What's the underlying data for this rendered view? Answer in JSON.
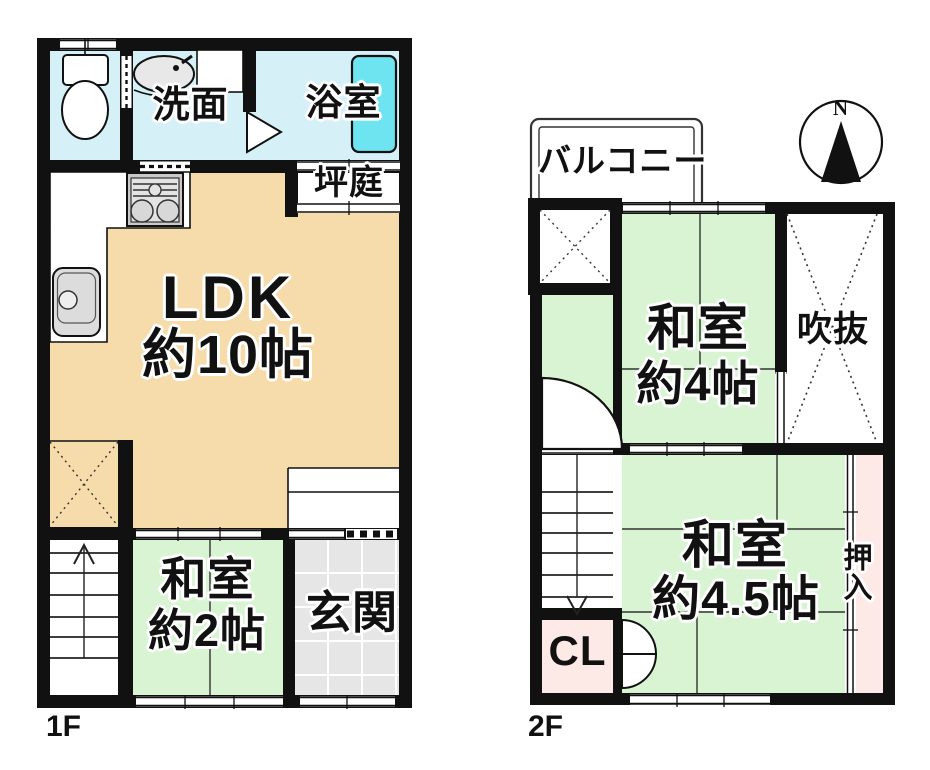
{
  "plan_title": "2-story floor plan",
  "colors": {
    "wall": "#111111",
    "water_room": "#d6f0f7",
    "bathtub": "#6ee4f0",
    "ldk": "#f7dcab",
    "tatami_room": "#d8f4d3",
    "entrance": "#e6e6e6",
    "closet_pink": "#fdeae7",
    "fixture_gray": "#dcdcdc"
  },
  "floor1": {
    "floor_label": "1F",
    "rooms": {
      "senmen": "洗面",
      "bathroom": "浴室",
      "tsuboniwa": "坪庭",
      "ldk_name": "LDK",
      "ldk_size": "約10帖",
      "washitsu_name": "和室",
      "washitsu_size": "約2帖",
      "genkan": "玄関"
    }
  },
  "floor2": {
    "floor_label": "2F",
    "rooms": {
      "balcony": "バルコニー",
      "washitsu4_name": "和室",
      "washitsu4_size": "約4帖",
      "fukinuke": "吹抜",
      "washitsu45_name": "和室",
      "washitsu45_size": "約4.5帖",
      "oshiire": "押入",
      "closet": "CL"
    }
  },
  "compass": {
    "north_label": "N"
  }
}
